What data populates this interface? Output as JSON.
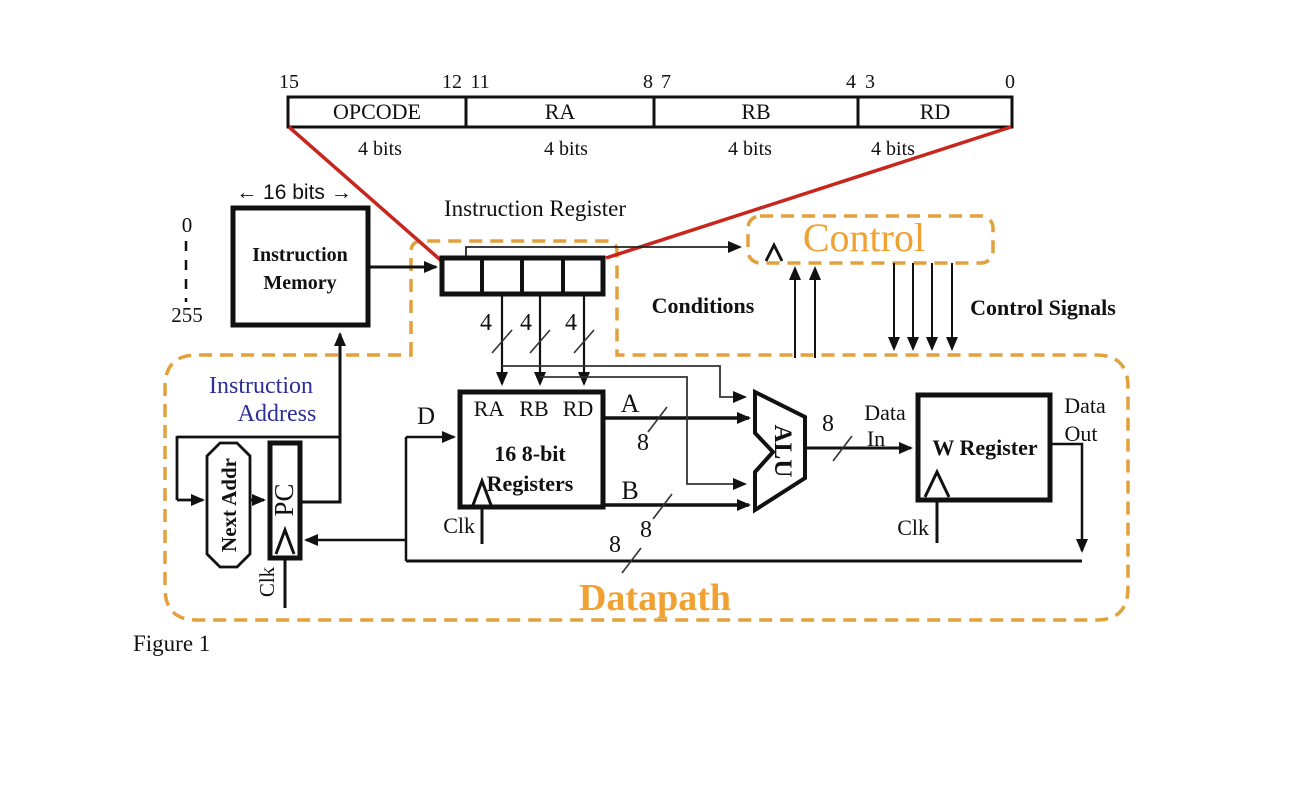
{
  "colors": {
    "dash_orange": "#E2A13C",
    "accent_orange": "#F0A132",
    "navy_text": "#2B2F96",
    "red_connector": "#C8251D",
    "ink": "#111111"
  },
  "instruction_format": {
    "bit_positions": [
      "15",
      "12",
      "11",
      "8",
      "7",
      "4",
      "3",
      "0"
    ],
    "fields": [
      {
        "name": "OPCODE",
        "size": "4 bits"
      },
      {
        "name": "RA",
        "size": "4 bits"
      },
      {
        "name": "RB",
        "size": "4 bits"
      },
      {
        "name": "RD",
        "size": "4 bits"
      }
    ]
  },
  "instruction_memory": {
    "width_label": "← 16 bits →",
    "line1": "Instruction",
    "line2": "Memory",
    "addr_first": "0",
    "addr_last": "255"
  },
  "instruction_register": {
    "label": "Instruction Register",
    "nibble_width": "4"
  },
  "control_unit": {
    "title": "Control",
    "conditions": "Conditions",
    "control_signals": "Control Signals"
  },
  "datapath": {
    "title": "Datapath",
    "instruction_address_line1": "Instruction",
    "instruction_address_line2": "Address",
    "next_addr": "Next Addr",
    "pc": "PC",
    "clk": "Clk",
    "d_port": "D",
    "a_port": "A",
    "b_port": "B",
    "regfile": {
      "ra": "RA",
      "rb": "RB",
      "rd": "RD",
      "line1": "16 8-bit",
      "line2": "Registers"
    },
    "alu": "ALU",
    "w_register": "W Register",
    "data_in_line1": "Data",
    "data_in_line2": "In",
    "data_out_line1": "Data",
    "data_out_line2": "Out",
    "byte_width": "8"
  },
  "caption": "Figure 1"
}
